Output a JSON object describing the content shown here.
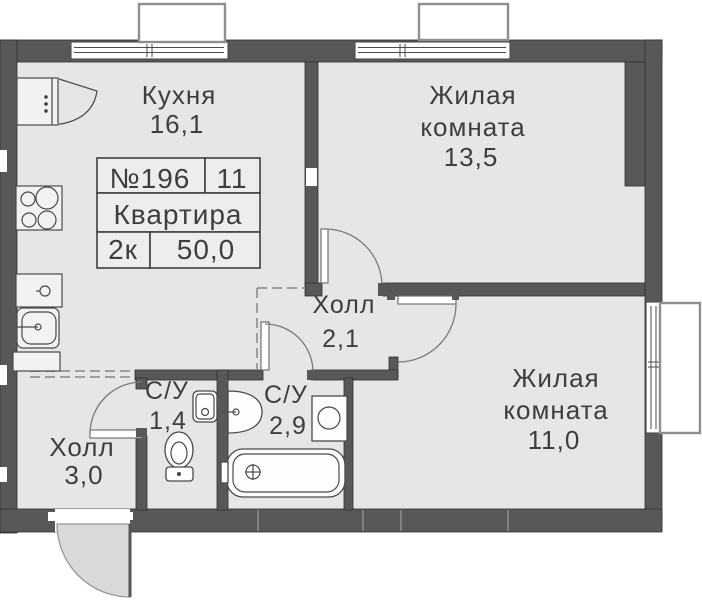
{
  "plan": {
    "apartment": {
      "number": "№196",
      "unit": "11",
      "type_label": "Квартира",
      "layout": "2к",
      "total_area": "50,0"
    },
    "rooms": {
      "kitchen": {
        "name": "Кухня",
        "area": "16,1"
      },
      "living1": {
        "line1": "Жилая",
        "line2": "комната",
        "area": "13,5"
      },
      "living2": {
        "line1": "Жилая",
        "line2": "комната",
        "area": "11,0"
      },
      "hall_inner": {
        "name": "Холл",
        "area": "2,1"
      },
      "hall_entry": {
        "name": "Холл",
        "area": "3,0"
      },
      "wc_small": {
        "name": "С/У",
        "area": "1,4"
      },
      "wc_large": {
        "name": "С/У",
        "area": "2,9"
      }
    },
    "colors": {
      "wall": "#585858",
      "floor": "#e6e6e6",
      "text": "#3e3e3e",
      "line": "#4a4a4a"
    }
  }
}
